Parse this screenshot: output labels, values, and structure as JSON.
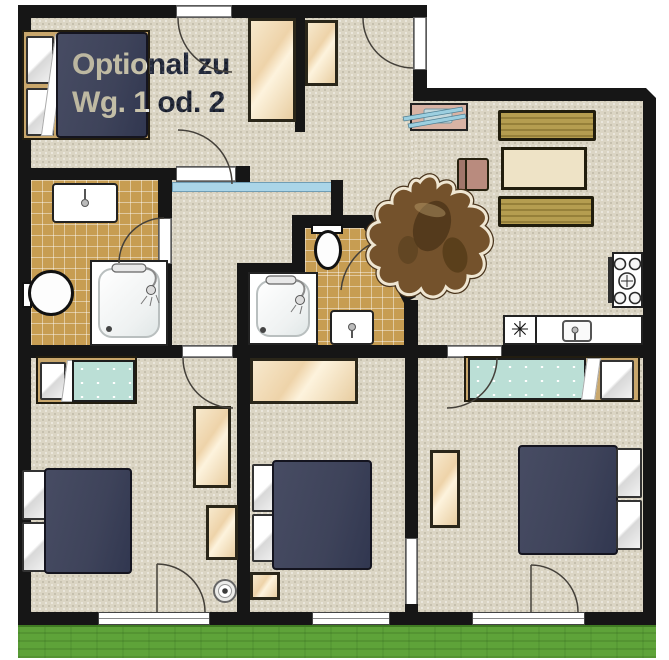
{
  "note": {
    "line1": "Optional zu",
    "line2": "Wg. 1 od. 2"
  },
  "kitchen": {
    "dishwasher_symbol": "✳"
  },
  "palette": {
    "wall": "#161616",
    "floor_beige": "#dbd5c4",
    "bathroom_tile": "#c79d52",
    "bed_navy": "#3e435a",
    "bed_teal": "#bbdfd6",
    "wardrobe_wood": "#eed3a9",
    "sofa_gold": "#a9914a",
    "coffee_table": "#eee3c6",
    "lawn_green": "#5ea339",
    "glass_partition_blue": "#aad5e8",
    "cowhide_brown": "#74522c",
    "tv_stand_pink": "#d9b3a4"
  }
}
